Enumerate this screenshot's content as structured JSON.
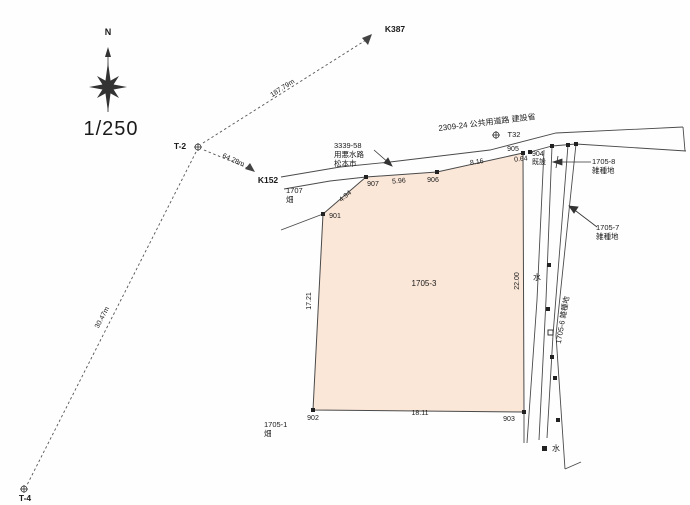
{
  "map": {
    "scale": "1/250",
    "north": "N"
  },
  "traverse": {
    "k387": "K387",
    "k387_distance": "187.79m",
    "t2": "T-2",
    "k152": "K152",
    "k152_distance": "64.28m",
    "t4": "T-4",
    "t4_distance": "30.47m",
    "t32": "T32"
  },
  "road": {
    "label": "2309-24 公共用道路 建設省"
  },
  "waterway": {
    "line1": "3339-58",
    "line2": "用悪水路",
    "line3": "松本市"
  },
  "parcels": {
    "main_id": "1705-3",
    "p1707_id": "1707",
    "p1707_type": "畑",
    "p1705_1_id": "1705-1",
    "p1705_1_type": "畑",
    "p1705_8_id": "1705-8",
    "p1705_8_type": "雑種地",
    "p1705_7_id": "1705-7",
    "p1705_7_type": "雑種地",
    "p1705_6_label": "1705-6 雑種地"
  },
  "points": {
    "p901": "901",
    "p902": "902",
    "p903": "903",
    "p904": "904",
    "p904_note": "既設",
    "p905": "905",
    "p906": "906",
    "p907": "907"
  },
  "measurements": {
    "top_907_906": "5.96",
    "top_906_905": "8.16",
    "top_905_904": "0.64",
    "left_edge": "17.21",
    "right_edge": "22.00",
    "bottom_edge": "18.11",
    "diag_901_907": "4.94"
  },
  "annotations": {
    "water_mid": "水",
    "water_bottom": "水"
  },
  "colors": {
    "parcel_fill": "#fbe7d8",
    "line": "#4a4a4a"
  }
}
